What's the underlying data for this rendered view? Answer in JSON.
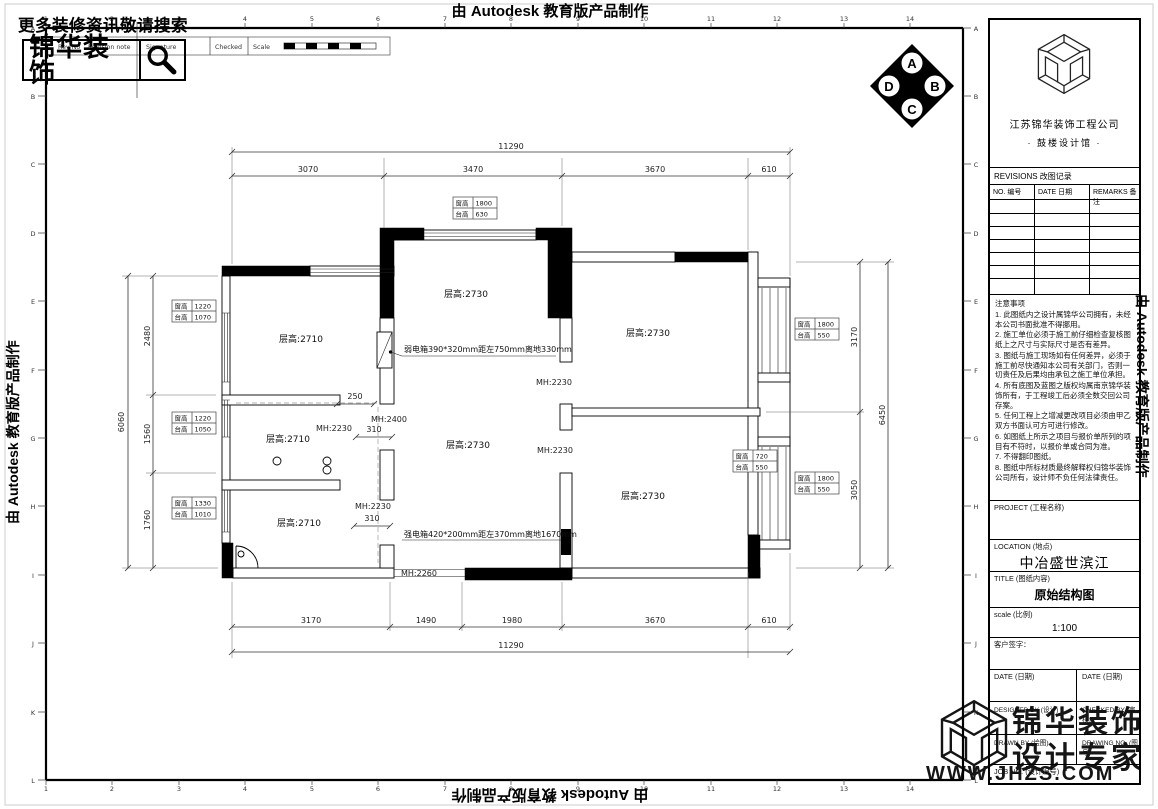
{
  "banners": {
    "top": "由 Autodesk 教育版产品制作",
    "bottom": "由 Autodesk 教育版产品制作",
    "left": "由 Autodesk 教育版产品制作",
    "right": "由 Autodesk 教育版产品制作"
  },
  "promo": {
    "headline": "更多装修资讯敬请搜索",
    "brand": "锦华装饰"
  },
  "rev_strip": {
    "rev_no": "Rev No",
    "revision_note": "Revision note",
    "signature": "Signature",
    "checked": "Checked",
    "scale": "Scale"
  },
  "compass": {
    "top": "A",
    "right": "B",
    "bottom": "C",
    "left": "D"
  },
  "ruler": {
    "numbers": [
      "1",
      "2",
      "3",
      "4",
      "5",
      "6",
      "7",
      "8",
      "9",
      "10",
      "11",
      "12",
      "13",
      "14"
    ],
    "letters": [
      "A",
      "B",
      "C",
      "D",
      "E",
      "F",
      "G",
      "H",
      "I",
      "J",
      "K",
      "L"
    ]
  },
  "titleblock": {
    "company": "江苏锦华装饰工程公司",
    "branch": "·  鼓楼设计馆  ·",
    "revisions_title": "REVISIONS 改图记录",
    "col_no": "NO. 编号",
    "col_date": "DATE 日期",
    "col_remarks": "REMARKS 备注",
    "notes_title": "注意事项",
    "notes": [
      "1. 此图纸内之设计属锦华公司拥有，未经本公司书面批准不得挪用。",
      "2. 施工单位必须于施工前仔细检查复核图纸上之尺寸与实际尺寸是否有差异。",
      "3. 图纸与施工现场如有任何差异，必须于施工前尽快通知本公司有关部门，否则一切责任及后果均由承包之施工单位承担。",
      "4. 所有底图及蓝图之版权均属南京锦华装饰所有，于工程竣工后必须全数交回公司存案。",
      "5. 任何工程上之增减更改项目必须由甲乙双方书面认可方可进行修改。",
      "6. 如图纸上所示之项目与报价单所列的项目有不符时，以报价单或合同为准。",
      "7. 不得翻印图纸。",
      "8. 图纸中所标材质最终解释权归锦华装饰公司所有，设计师不负任何法律责任。"
    ],
    "project_label": "PROJECT (工程名称)",
    "location_label": "LOCATION (地点)",
    "location_value": "中冶盛世滨江",
    "title_label": "TITLE (图纸内容)",
    "title_value": "原始结构图",
    "scale_label": "scale (比例)",
    "scale_value": "1:100",
    "client_label": "客户签字：",
    "date_label_left": "DATE (日期)",
    "date_label_right": "DATE (日期)",
    "designed_label": "DESIGNED BY (设计)",
    "checked_label": "CHECKED BY (审核)",
    "drawn_label": "DRAWN BY (绘图)",
    "drawing_no_label": "DRAWING NO. (图号)",
    "job_no_label": "JOB NO. (设计编号)"
  },
  "footer_logo": {
    "brand_line1": "锦华装饰",
    "brand_line2": "设计专家",
    "website": "WWW.JHZS.COM"
  },
  "plan": {
    "dims": {
      "top_total": "11290",
      "top": [
        "3070",
        "3470",
        "3670",
        "610"
      ],
      "bottom": [
        "3170",
        "1490",
        "1980",
        "3670",
        "610"
      ],
      "bottom_total": "11290",
      "left_total": "6060",
      "left": [
        "2480",
        "1560",
        "1760"
      ],
      "right_total": "6450",
      "right": [
        "3170",
        "3050"
      ],
      "inner": [
        "250",
        "310",
        "310"
      ]
    },
    "rooms": [
      "层高:2710",
      "层高:2710",
      "层高:2710",
      "层高:2730",
      "层高:2730",
      "层高:2730",
      "层高:2730"
    ],
    "doors": [
      "MH:2230",
      "MH:2400",
      "MH:2230",
      "MH:2230",
      "MH:2230",
      "MH:2260"
    ],
    "annotations": {
      "weak_box": "弱电箱390*320mm距左750mm离地330mm",
      "strong_box": "强电箱420*200mm距左370mm离地1670mm"
    },
    "window_tables": [
      {
        "r1l": "窗高",
        "r1v": "1800",
        "r2l": "台高",
        "r2v": "630"
      },
      {
        "r1l": "窗高",
        "r1v": "1220",
        "r2l": "台高",
        "r2v": "1070"
      },
      {
        "r1l": "窗高",
        "r1v": "1220",
        "r2l": "台高",
        "r2v": "1050"
      },
      {
        "r1l": "窗高",
        "r1v": "1330",
        "r2l": "台高",
        "r2v": "1010"
      },
      {
        "r1l": "窗高",
        "r1v": "1800",
        "r2l": "台高",
        "r2v": "550"
      },
      {
        "r1l": "窗高",
        "r1v": "720",
        "r2l": "台高",
        "r2v": "550"
      },
      {
        "r1l": "窗高",
        "r1v": "1800",
        "r2l": "台高",
        "r2v": "550"
      }
    ]
  }
}
